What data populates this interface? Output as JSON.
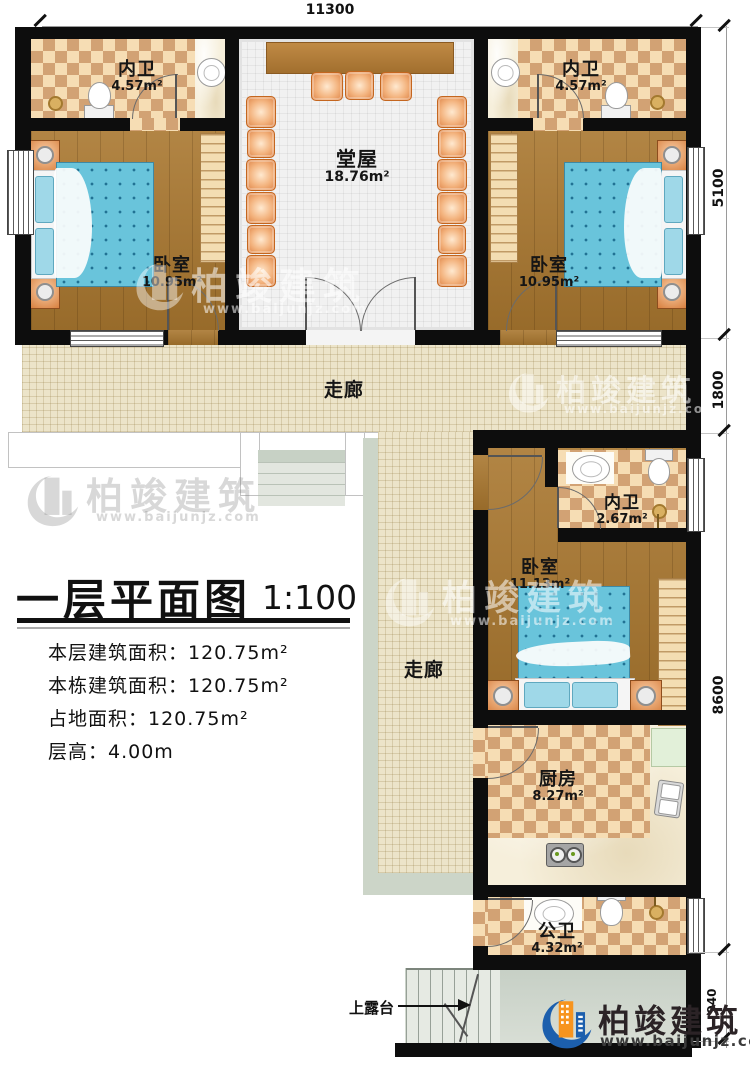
{
  "dimensions": {
    "top": "11300",
    "right_top": "5100",
    "right_mid": "1800",
    "right_main": "8600",
    "right_bottom": "940"
  },
  "rooms": {
    "bath_left": {
      "name": "内卫",
      "area": "4.57m²"
    },
    "bath_right": {
      "name": "内卫",
      "area": "4.57m²"
    },
    "hall": {
      "name": "堂屋",
      "area": "18.76m²"
    },
    "bedroom_left": {
      "name": "卧室",
      "area": "10.95m²"
    },
    "bedroom_right": {
      "name": "卧室",
      "area": "10.95m²"
    },
    "corridor_h": {
      "name": "走廊"
    },
    "corridor_v": {
      "name": "走廊"
    },
    "bath_small": {
      "name": "内卫",
      "area": "2.67m²"
    },
    "bedroom_south": {
      "name": "卧室",
      "area": "11.13m²"
    },
    "kitchen": {
      "name": "厨房",
      "area": "8.27m²"
    },
    "bath_public": {
      "name": "公卫",
      "area": "4.32m²"
    }
  },
  "title": {
    "text": "一层平面图",
    "scale": "1:100"
  },
  "stats": {
    "line1": "本层建筑面积：120.75m²",
    "line2": "本栋建筑面积：120.75m²",
    "line3": "占地面积：120.75m²",
    "line4": "层高：4.00m"
  },
  "terrace_label": "上露台",
  "logo": {
    "name": "柏竣建筑",
    "site": "www.baijunjz.com"
  },
  "watermark": {
    "name": "柏竣建筑",
    "site": "www.baijunjz.com"
  },
  "colors": {
    "wall": "#0d0d0d",
    "checker_light": "#f6ddb4",
    "checker_dark": "#d2a274",
    "wood": "#a9772f",
    "corridor": "#ece4c9",
    "hall_floor": "#f1f1f1",
    "terrace": "#ccd5cb",
    "bed": "#69c4db",
    "furniture_orange": "#e69a5d",
    "logo_blue": "#1c5fad",
    "logo_orange": "#f7941e"
  }
}
